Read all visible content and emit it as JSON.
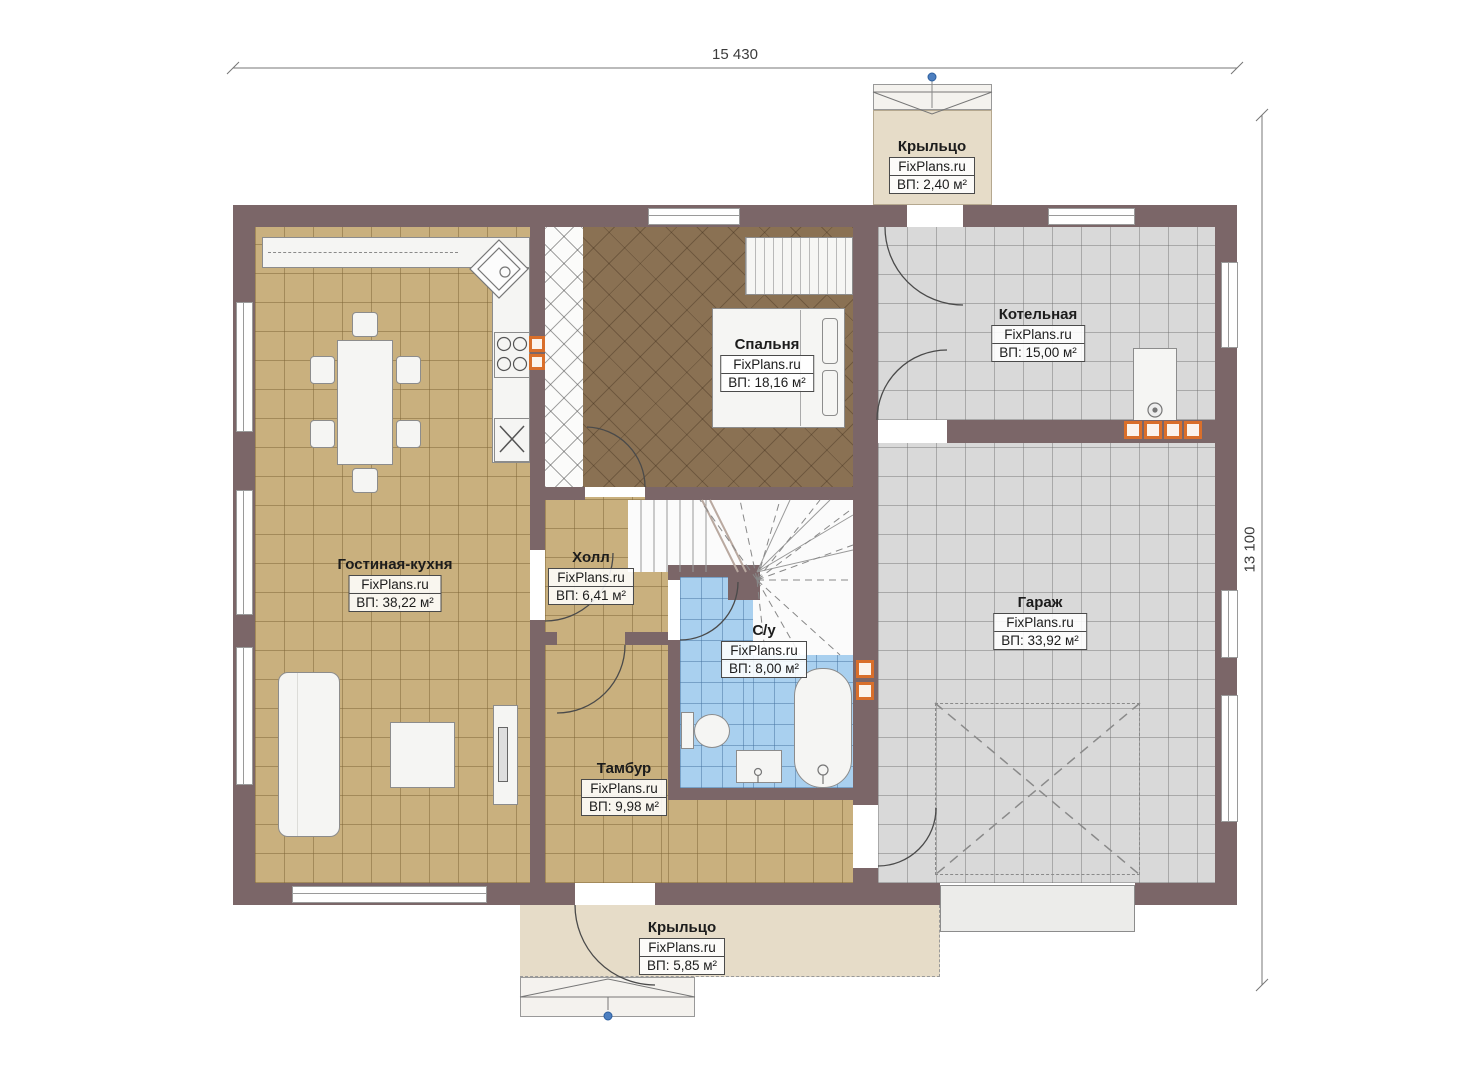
{
  "plan": {
    "top_dimension": "15 430",
    "right_dimension": "13 100",
    "watermark": "FixPlans.ru",
    "rooms": {
      "porch_top": {
        "name": "Крыльцо",
        "area": "ВП: 2,40 м²"
      },
      "bedroom": {
        "name": "Спальня",
        "area": "ВП: 18,16 м²"
      },
      "boiler_room": {
        "name": "Котельная",
        "area": "ВП: 15,00 м²"
      },
      "living_kitchen": {
        "name": "Гостиная-кухня",
        "area": "ВП: 38,22 м²"
      },
      "hall": {
        "name": "Холл",
        "area": "ВП: 6,41 м²"
      },
      "bathroom": {
        "name": "С/у",
        "area": "ВП: 8,00 м²"
      },
      "vestibule": {
        "name": "Тамбур",
        "area": "ВП: 9,98 м²"
      },
      "garage": {
        "name": "Гараж",
        "area": "ВП: 33,92 м²"
      },
      "porch_bottom": {
        "name": "Крыльцо",
        "area": "ВП: 5,85 м²"
      }
    },
    "colors": {
      "wall": "#7b6668",
      "tile_tan": "#c9b07e",
      "tile_grey": "#d9d9d9",
      "tile_blue": "#a9d0ef",
      "bedroom_floor": "#8a7153",
      "porch": "#e6dcc8",
      "vent_orange": "#d96f2b",
      "entry_marker_blue": "#4d7fc0"
    }
  }
}
